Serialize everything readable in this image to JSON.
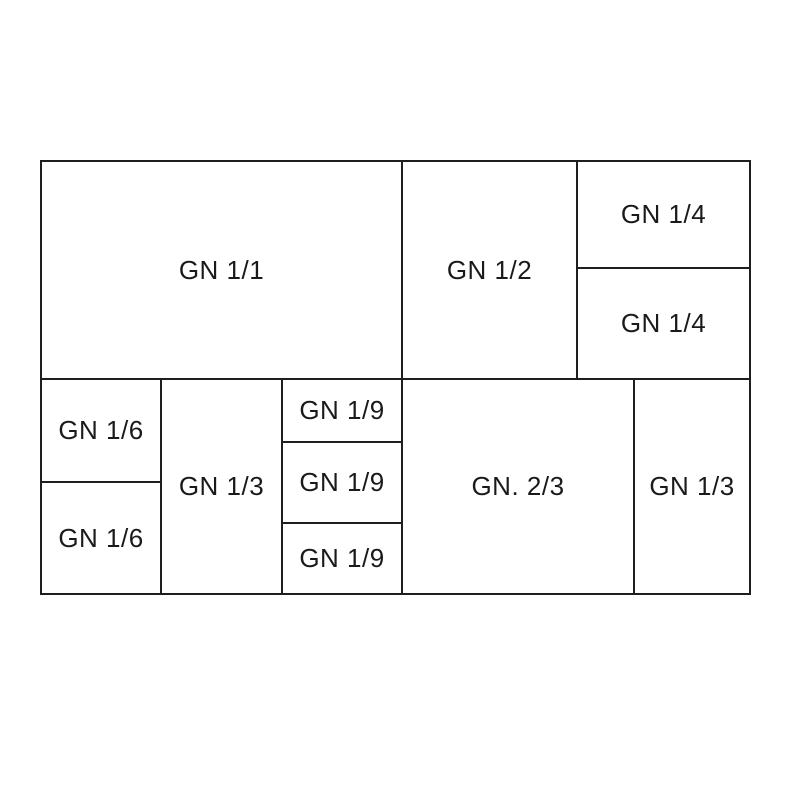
{
  "diagram": {
    "line_color": "#1e1e1e",
    "text_color": "#1a1a1a",
    "background_color": "#ffffff",
    "cells": [
      {
        "id": "gn-1-1",
        "label": "GN 1/1"
      },
      {
        "id": "gn-1-2",
        "label": "GN 1/2"
      },
      {
        "id": "gn-1-4-top",
        "label": "GN 1/4"
      },
      {
        "id": "gn-1-4-bottom",
        "label": "GN 1/4"
      },
      {
        "id": "gn-1-6-top",
        "label": "GN 1/6"
      },
      {
        "id": "gn-1-6-bottom",
        "label": "GN 1/6"
      },
      {
        "id": "gn-1-3-left",
        "label": "GN 1/3"
      },
      {
        "id": "gn-1-9-top",
        "label": "GN 1/9"
      },
      {
        "id": "gn-1-9-middle",
        "label": "GN 1/9"
      },
      {
        "id": "gn-1-9-bottom",
        "label": "GN 1/9"
      },
      {
        "id": "gn-2-3",
        "label": "GN. 2/3"
      },
      {
        "id": "gn-1-3-right",
        "label": "GN 1/3"
      }
    ]
  }
}
